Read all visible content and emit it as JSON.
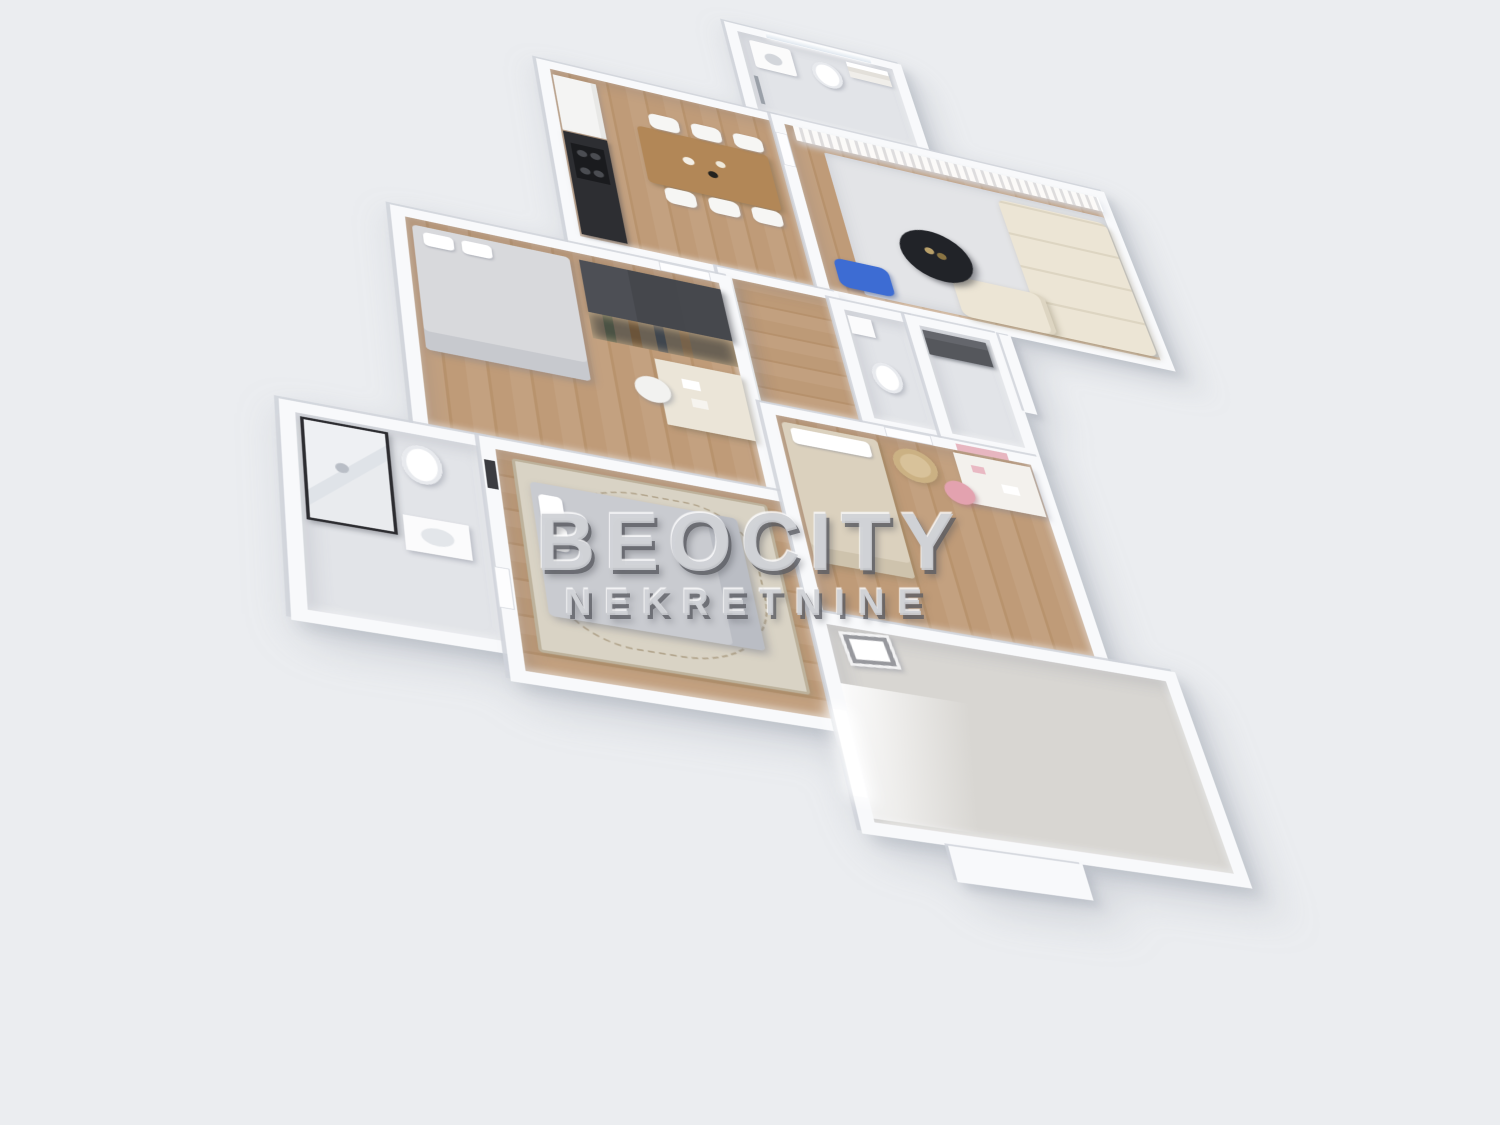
{
  "watermark": {
    "brand": "BEOCITY",
    "tagline": "NEKRETNINE"
  },
  "scene": {
    "type": "3d-floor-plan-render",
    "view": "aerial axonometric, plan rotated diagonally",
    "background_color": "#ebedf0",
    "wall_color": "#f8f9fb",
    "wood_floor_color": "#bd9a77",
    "rug_color": "#e3e4e7",
    "sofa_color": "#ece5d5",
    "coffee_table_color": "#212328",
    "accent_blue": "#3d6cd3",
    "wardrobe_color": "#46484d",
    "watermark_color": "#cdcfd4"
  },
  "rooms": [
    {
      "name": "bathroom-top",
      "floor": "tile",
      "furniture": [
        "window",
        "washing-machine",
        "toilet",
        "towel-shelf",
        "towel-rack"
      ]
    },
    {
      "name": "kitchen-dining",
      "floor": "wood",
      "furniture": [
        "fridge-cabinet",
        "dark-counter-with-stove",
        "dining-table",
        "six-white-chairs"
      ]
    },
    {
      "name": "living-room",
      "floor": "wood-and-rug",
      "furniture": [
        "sheer-curtains",
        "modular-cream-sofa",
        "round-black-coffee-table",
        "blue-seat",
        "light-rug"
      ]
    },
    {
      "name": "hallway",
      "floor": "wood",
      "furniture": []
    },
    {
      "name": "wc",
      "floor": "tile",
      "furniture": [
        "toilet",
        "small-sink"
      ]
    },
    {
      "name": "storage",
      "floor": "tile",
      "furniture": [
        "dark-shelf-unit"
      ]
    },
    {
      "name": "master-bedroom",
      "floor": "wood",
      "furniture": [
        "double-bed",
        "dark-wardrobe",
        "lit-open-closet",
        "desk",
        "chair"
      ]
    },
    {
      "name": "bathroom-lower",
      "floor": "tile",
      "furniture": [
        "glass-shower-black-frame",
        "toilet",
        "sink"
      ]
    },
    {
      "name": "bedroom-2",
      "floor": "wood",
      "furniture": [
        "gray-double-bed",
        "patterned-rug",
        "wall-frame"
      ]
    },
    {
      "name": "kids-room",
      "floor": "wood",
      "furniture": [
        "single-bed",
        "rattan-chair",
        "white-desk",
        "pink-chair",
        "pink-shelf"
      ]
    },
    {
      "name": "empty-room",
      "floor": "pale",
      "furniture": [
        "glowing-window",
        "leaning-picture-frame"
      ]
    },
    {
      "name": "porch",
      "floor": "wall-slab",
      "furniture": []
    }
  ]
}
